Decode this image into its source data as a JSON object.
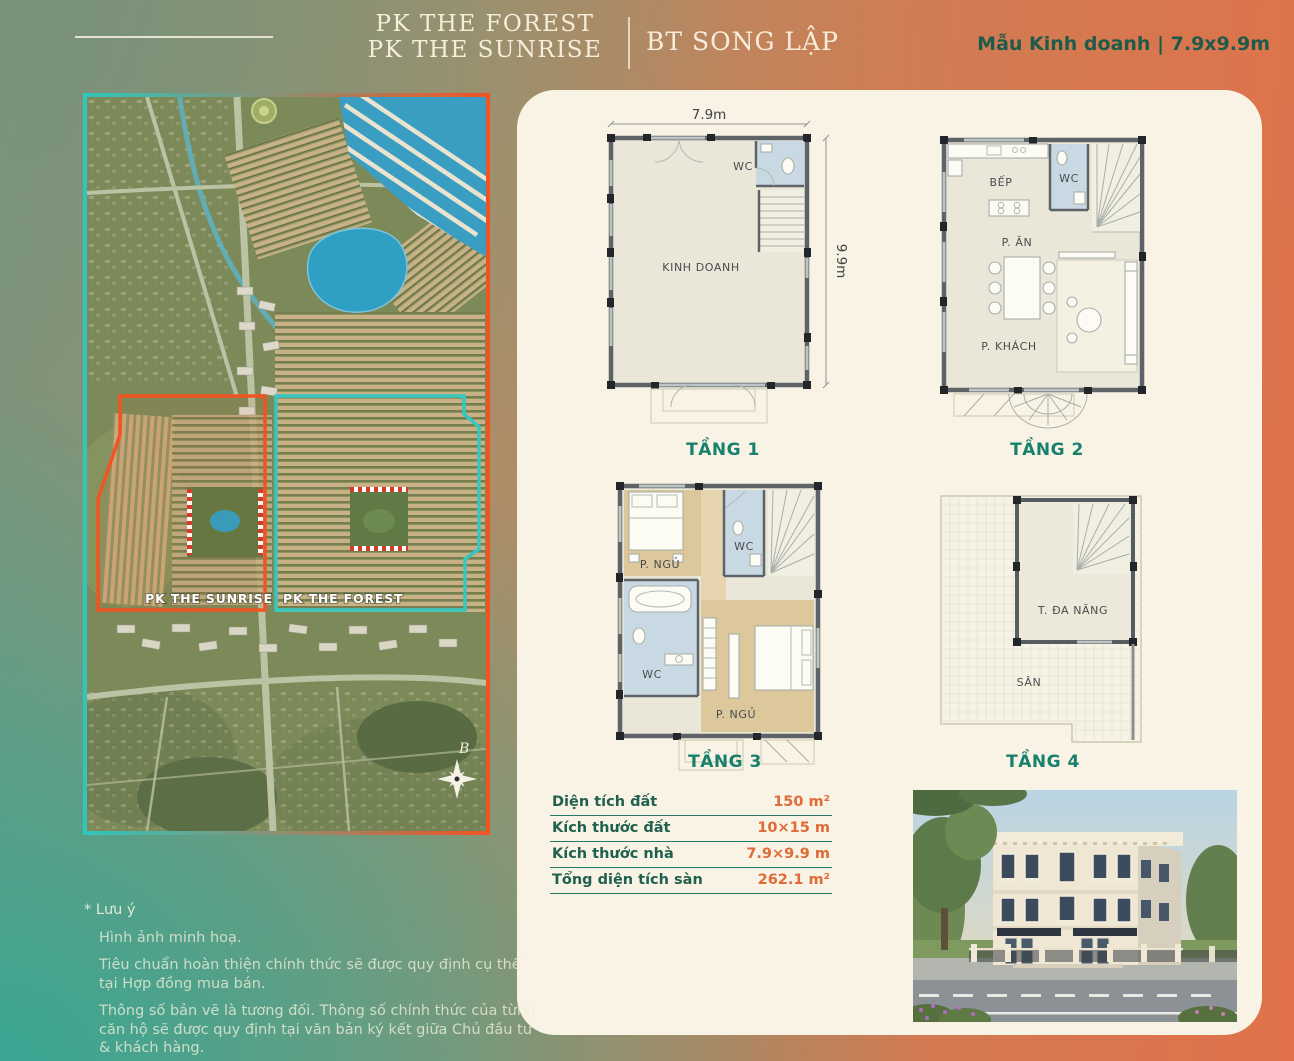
{
  "header": {
    "project_line1": "PK THE FOREST",
    "project_line2": "PK THE SUNRISE",
    "product_type": "BT SONG LẬP",
    "model_info": "Mẫu Kinh doanh | 7.9x9.9m"
  },
  "map": {
    "zone_sunrise": "PK THE SUNRISE",
    "zone_forest": "PK THE FOREST",
    "compass_north": "B"
  },
  "plans": {
    "dim_width": "7.9m",
    "dim_depth": "9.9m",
    "floor1": {
      "title": "TẦNG 1",
      "room_main": "KINH DOANH",
      "room_wc": "WC"
    },
    "floor2": {
      "title": "TẦNG 2",
      "room_kitchen": "BẾP",
      "room_wc": "WC",
      "room_dining": "P. ĂN",
      "room_living": "P. KHÁCH"
    },
    "floor3": {
      "title": "TẦNG 3",
      "room_bed1": "P. NGỦ",
      "room_wc1": "WC",
      "room_wc2": "WC",
      "room_bed2": "P. NGỦ"
    },
    "floor4": {
      "title": "TẦNG 4",
      "room_multi": "T. ĐA NĂNG",
      "room_yard": "SÂN"
    }
  },
  "specs": {
    "rows": [
      {
        "label": "Diện tích đất",
        "value": "150 m²"
      },
      {
        "label": "Kích thước đất",
        "value": "10×15 m"
      },
      {
        "label": "Kích thước nhà",
        "value": "7.9×9.9 m"
      },
      {
        "label": "Tổng diện tích sàn",
        "value": "262.1 m²"
      }
    ]
  },
  "notes": {
    "title": "* Lưu ý",
    "line1": "Hình ảnh minh hoạ.",
    "line2": "Tiêu chuẩn hoàn thiện chính thức sẽ được quy định cụ thể tại Hợp đồng mua bán.",
    "line3": "Thông số bản vẽ là tương đối. Thông số chính thức của từng căn hộ sẽ được quy định tại văn bản ký kết giữa Chủ đầu tư & khách hàng."
  },
  "colors": {
    "accent_teal": "#18806c",
    "accent_orange": "#e06a38",
    "map_border_teal": "#2fc6bd",
    "map_border_orange": "#f05423",
    "panel_cream": "#f8f3e4"
  }
}
